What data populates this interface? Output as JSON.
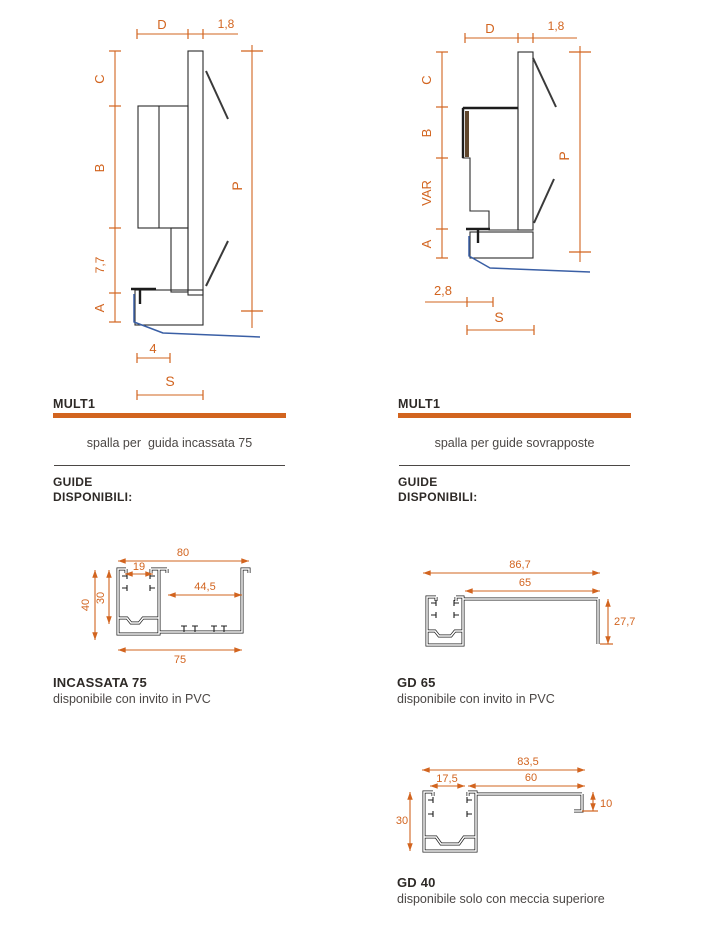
{
  "colors": {
    "accent": "#d2641f",
    "blue": "#3a5fa5",
    "wood": "#d8bd8e",
    "dark_text": "#2e2a27",
    "gray_text": "#4b4745"
  },
  "left_column": {
    "title": "MULT1",
    "caption": "spalla per  guida incassata 75",
    "guide_line1": "GUIDE",
    "guide_line2": "DISPONIBILI:",
    "labels": {
      "d": "D",
      "t18": "1,8",
      "c": "C",
      "b": "B",
      "n77": "7,7",
      "a": "A",
      "p": "P",
      "n4": "4",
      "s": "S"
    },
    "profile": {
      "title": "INCASSATA 75",
      "note": "disponibile con invito in PVC",
      "dims": {
        "n80": "80",
        "n19": "19",
        "n445": "44,5",
        "n40": "40",
        "n30": "30",
        "n75": "75"
      }
    }
  },
  "right_column": {
    "title": "MULT1",
    "caption": "spalla per guide sovrapposte",
    "guide_line1": "GUIDE",
    "guide_line2": "DISPONIBILI:",
    "labels": {
      "d": "D",
      "t18": "1,8",
      "c": "C",
      "b": "B",
      "var": "VAR",
      "a": "A",
      "p": "P",
      "n28": "2,8",
      "s": "S"
    },
    "gd65": {
      "title": "GD 65",
      "note": "disponibile con invito in PVC",
      "dims": {
        "n867": "86,7",
        "n65": "65",
        "n277": "27,7"
      }
    },
    "gd40": {
      "title": "GD 40",
      "note": "disponibile solo con meccia superiore",
      "dims": {
        "n835": "83,5",
        "n60": "60",
        "n175": "17,5",
        "n30": "30",
        "n10": "10"
      }
    }
  }
}
